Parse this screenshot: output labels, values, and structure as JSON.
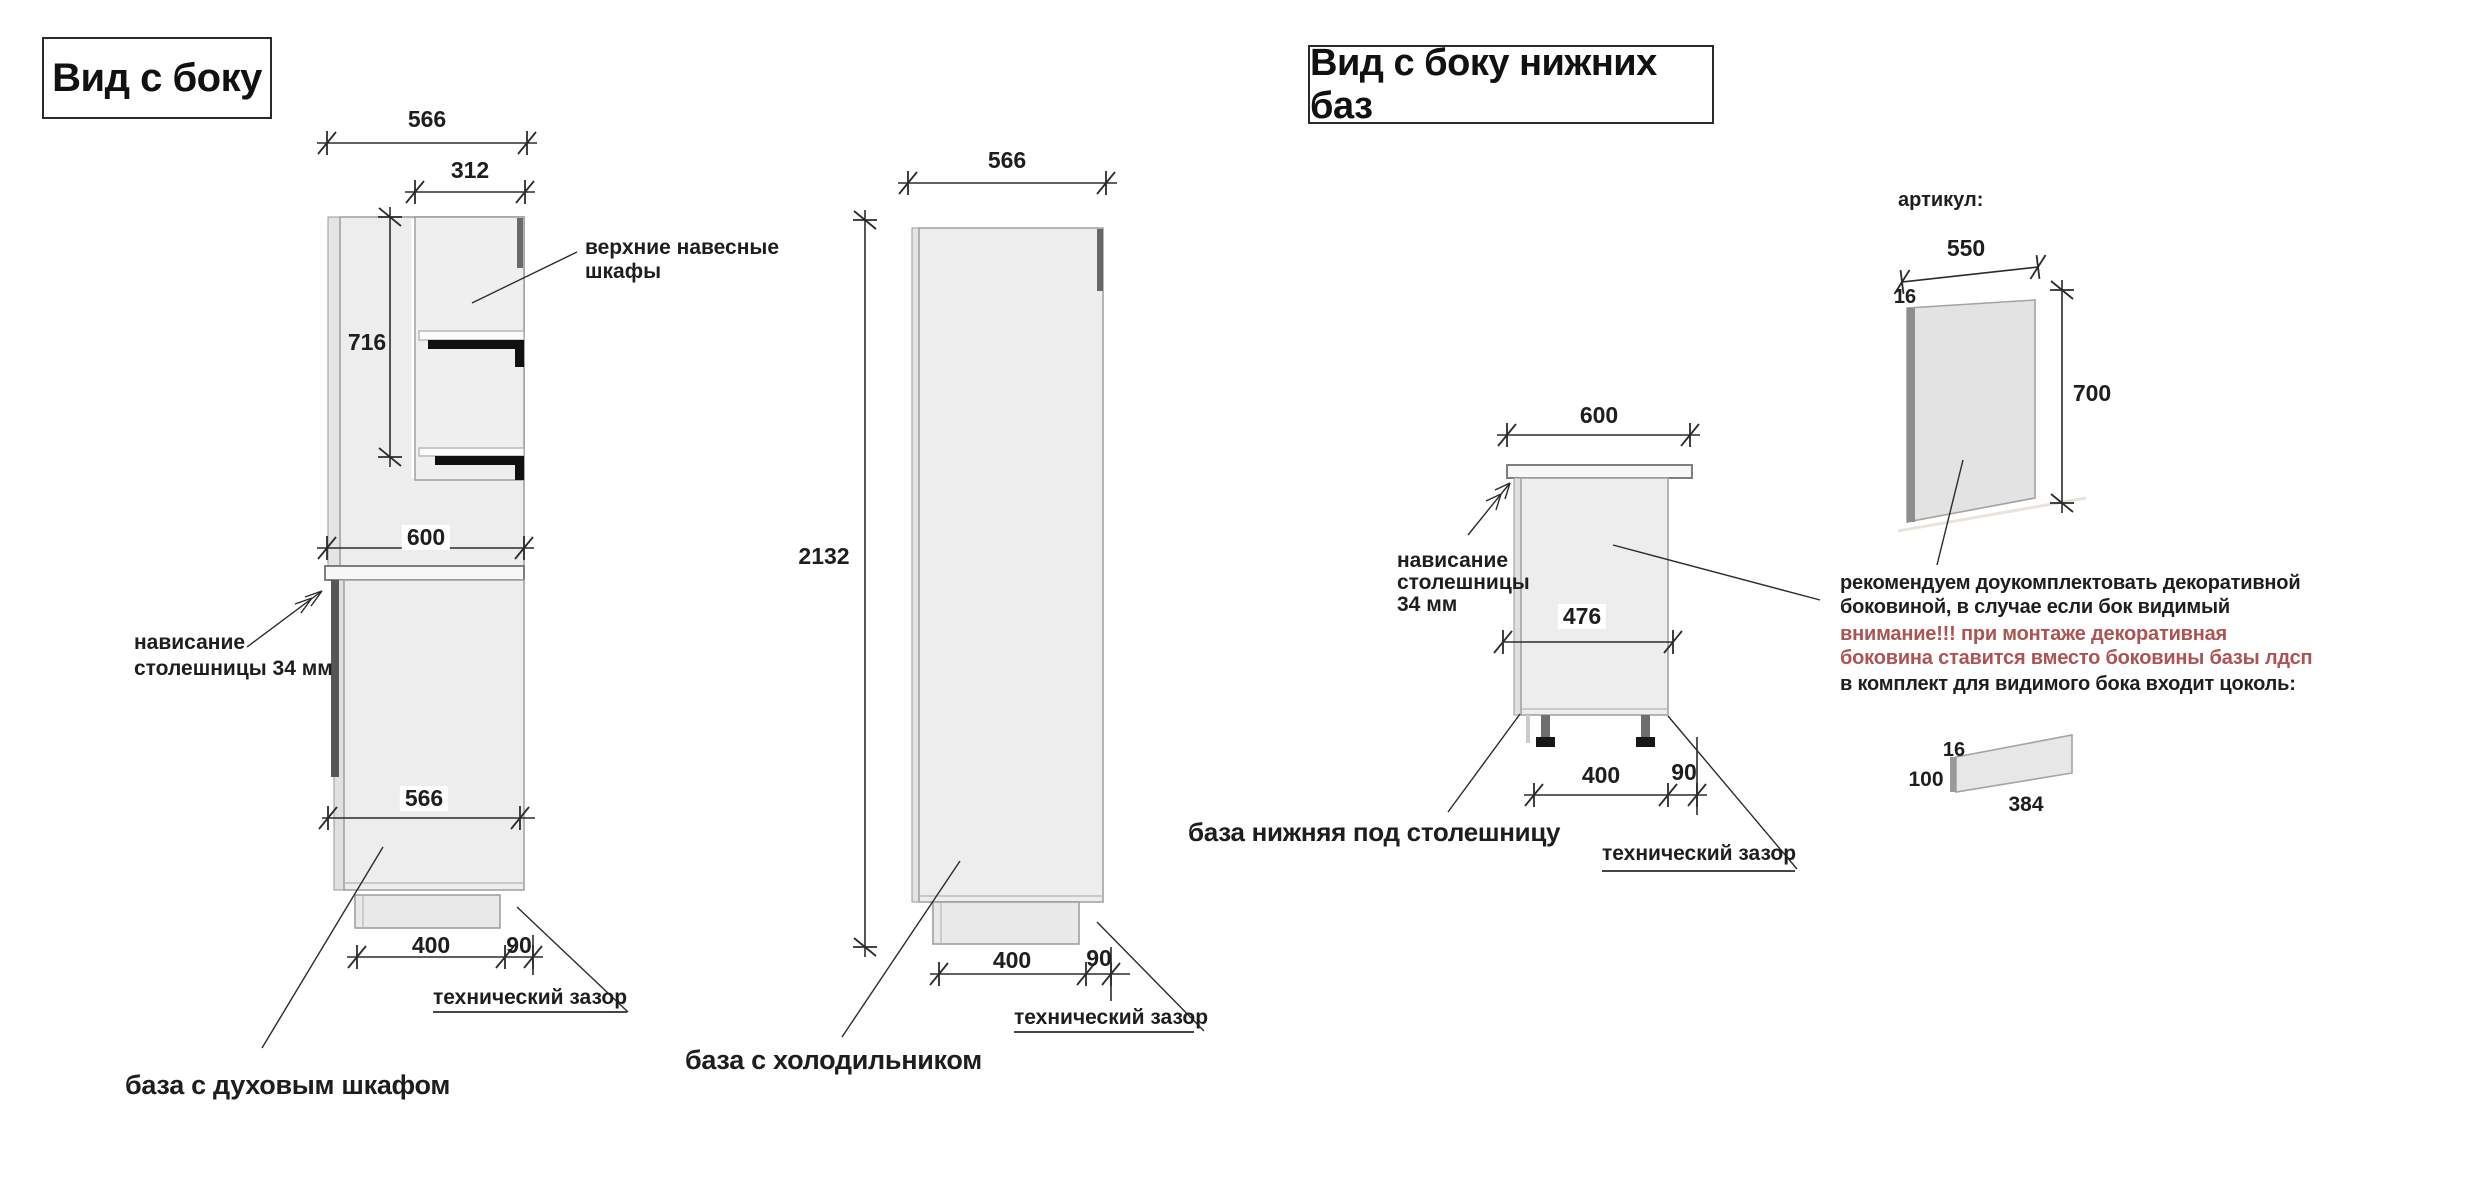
{
  "titles": {
    "left": "Вид с боку",
    "right": "Вид с боку нижних баз"
  },
  "oven": {
    "name": "база с духовым шкафом",
    "dim_top": "566",
    "dim_wall": "312",
    "dim_wall_height": "716",
    "dim_counter": "600",
    "dim_depth": "566",
    "dim_plinth": "400",
    "dim_gap": "90",
    "wall_label_1": "верхние навесные",
    "wall_label_2": "шкафы",
    "overhang_1": "нависание",
    "overhang_2": "столешницы 34 мм",
    "techgap": "технический зазор"
  },
  "fridge": {
    "name": "база с холодильником",
    "dim_top": "566",
    "dim_height": "2132",
    "dim_plinth": "400",
    "dim_gap": "90",
    "techgap": "технический зазор"
  },
  "base": {
    "name": "база нижняя под столешницу",
    "dim_top": "600",
    "dim_front": "476",
    "dim_plinth": "400",
    "dim_gap": "90",
    "overhang_1": "нависание",
    "overhang_2": "столешницы",
    "overhang_3": "34 мм",
    "techgap": "технический зазор"
  },
  "panel": {
    "article_label": "артикул:",
    "dim_width": "550",
    "dim_thickness": "16",
    "dim_height": "700"
  },
  "plinth": {
    "dim_thickness": "16",
    "dim_height": "100",
    "dim_length": "384"
  },
  "note": {
    "line1": "рекомендуем доукомплектовать декоративной",
    "line2": "боковиной, в случае если бок видимый",
    "line3": "внимание!!! при монтаже декоративная",
    "line4": "боковина ставится вместо боковины базы лдсп",
    "line5": "в комплект для видимого бока входит цоколь:"
  },
  "colors": {
    "warning_red": "#ae5353",
    "ink": "#1e1e1e",
    "cabinet_fill": "#ededed",
    "cabinet_stroke": "#a3a3a3",
    "dark_edge": "#565656"
  }
}
